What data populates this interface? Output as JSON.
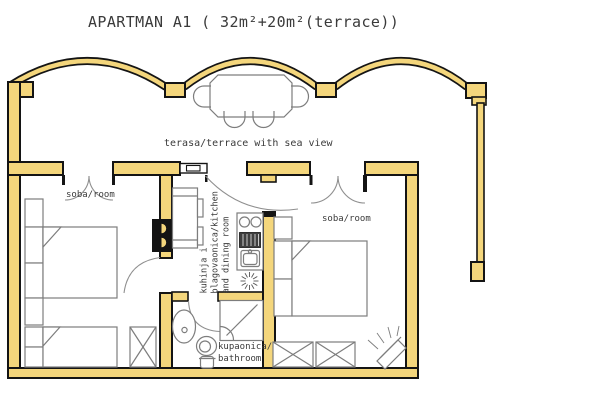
{
  "title": "APARTMAN A1 ( 32m²+20m²(terrace))",
  "labels": {
    "terrace": "terasa/terrace with sea view",
    "room_left": "soba/room",
    "room_right": "soba/room",
    "kitchen": {
      "line1": "kuhinja i",
      "line2": "blagovaonica/kitchen",
      "line3": "and dining room"
    },
    "bathroom": {
      "line1": "kupaonica/",
      "line2": "bathroom"
    }
  },
  "colors": {
    "wall_fill": "#f4d67c",
    "outline": "#141414",
    "furniture": "#7d7d7d",
    "door_arc": "#8f8f8f",
    "text": "#3a3a3a",
    "background": "#ffffff"
  }
}
